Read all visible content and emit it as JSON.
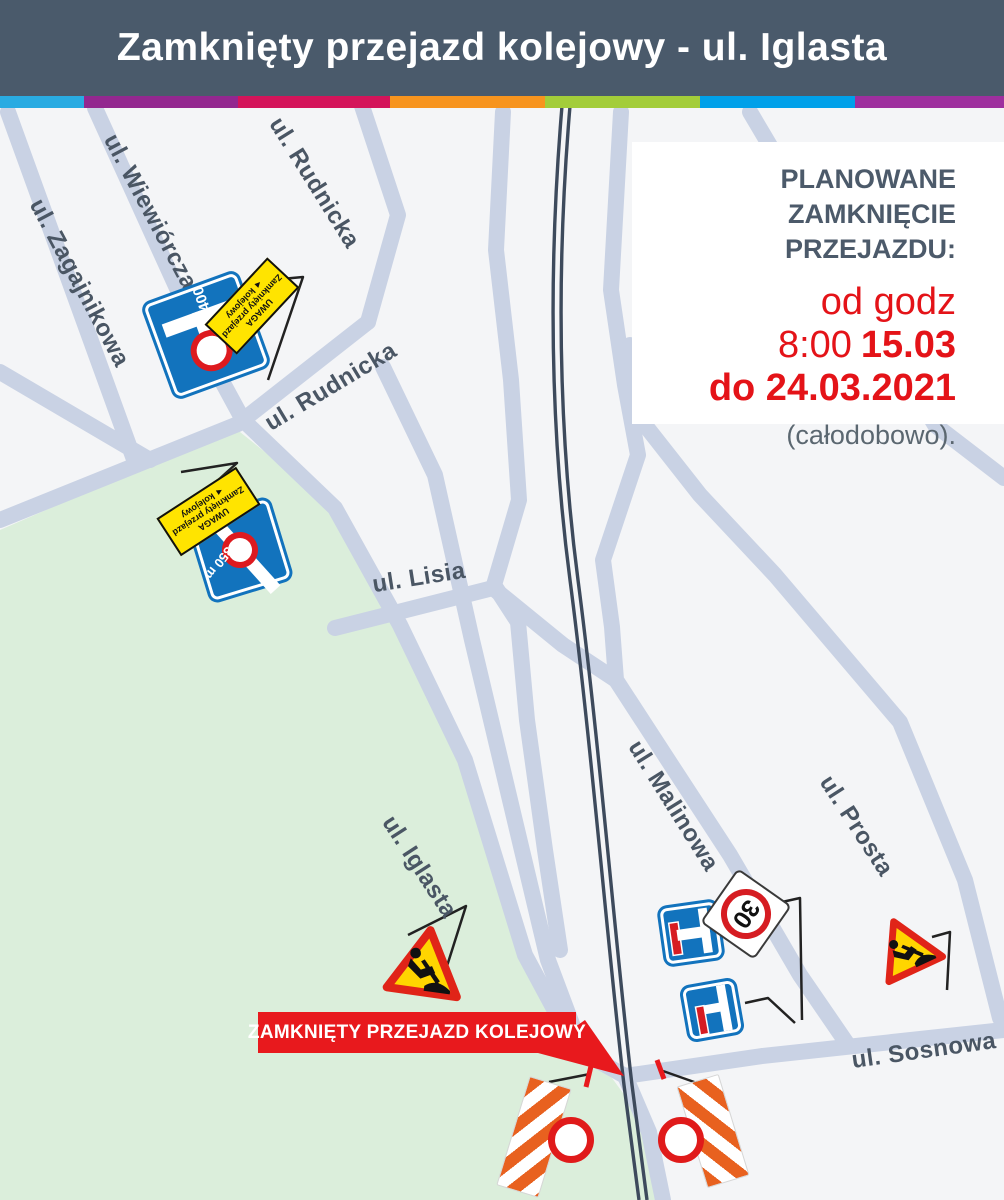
{
  "header": {
    "title": "Zamknięty przejazd kolejowy - ul. Iglasta"
  },
  "stripe": {
    "colors": [
      "#29abe2",
      "#93278f",
      "#d4145a",
      "#f7941e",
      "#a3cd3a",
      "#00a0e9",
      "#9e2f9e"
    ]
  },
  "notice": {
    "title_lines": [
      "PLANOWANE",
      "ZAMKNIĘCIE",
      "PRZEJAZDU:"
    ],
    "period_prefix": "od godz 8:00",
    "period_start": "15.03",
    "period_line2": "do 24.03.2021",
    "note": "(całodobowo)."
  },
  "street_labels": [
    "ul. Wiewiórcza",
    "ul. Zagajnikowa",
    "ul. Rudnicka",
    "ul. Rudnicka",
    "ul. Lisia",
    "ul. Iglasta",
    "ul. Malinowa",
    "ul. Prosta",
    "ul. Sosnowa"
  ],
  "banner": {
    "label": "ZAMKNIĘTY PRZEJAZD KOLEJOWY"
  },
  "signs": {
    "dead_end_distance_400": "400",
    "dead_end_distance_350": "350 m",
    "speed_limit": "30",
    "plaque": {
      "line1": "UWAGA",
      "line2": "Zamknięty przejazd",
      "line3": "kolejowy"
    }
  },
  "icons": {
    "plaque_arrow": "◄"
  },
  "colors": {
    "header_bg": "#4a5a6b",
    "map_bg": "#f4f5f7",
    "street": "#c9d2e4",
    "railway": "#3d4a5c",
    "green_area": "#dbeedb",
    "sign_blue": "#1273bd",
    "alert_red": "#e8191d",
    "notice_title": "#4c5a6a",
    "notice_red": "#e41318",
    "note_gray": "#5b6770",
    "label_color": "#4a5664",
    "plaque_yellow": "#ffe400",
    "barrier_orange": "#e8611f",
    "triangle_yellow": "#ffd500",
    "triangle_red": "#e02418"
  }
}
